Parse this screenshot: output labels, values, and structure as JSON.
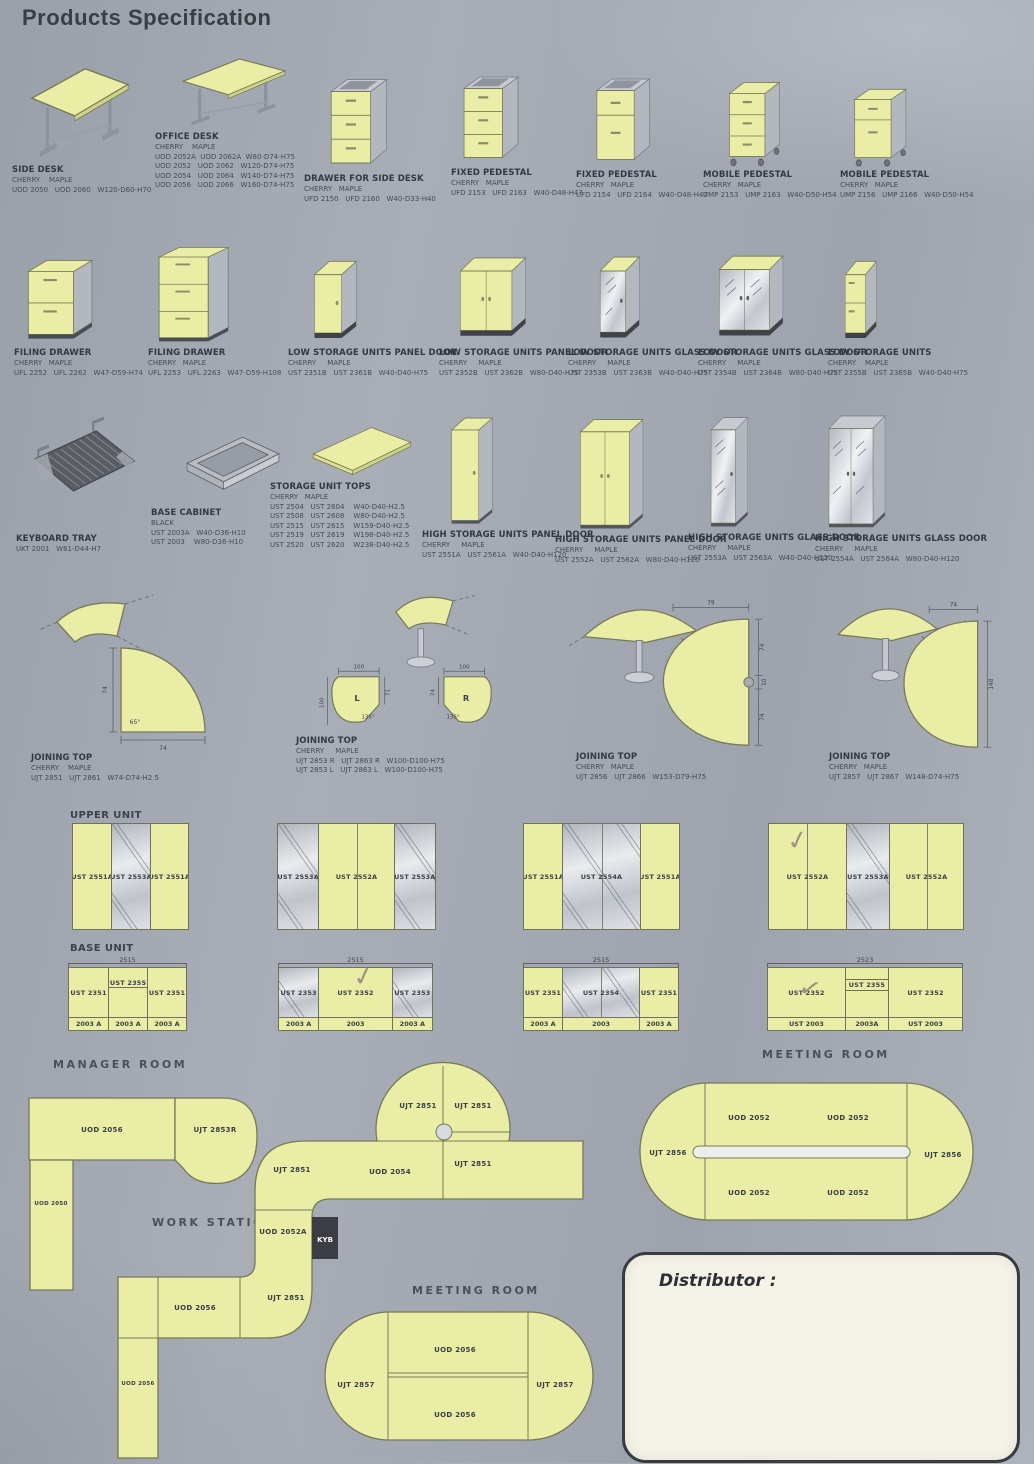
{
  "page": {
    "title": "Products Specification"
  },
  "products": [
    {
      "name": "SIDE DESK",
      "finishes": "CHERRY    MAPLE",
      "rows": [
        "UOD 2050   UOD 2060   W120-D60-H70"
      ]
    },
    {
      "name": "OFFICE DESK",
      "finishes": "CHERRY    MAPLE",
      "rows": [
        "UOD 2052A  UOD 2062A  W80-D74-H75",
        "UOD 2052   UOD 2062   W120-D74-H75",
        "UOD 2054   UOD 2064   W140-D74-H75",
        "UOD 2056   UOD 2066   W160-D74-H75"
      ]
    },
    {
      "name": "DRAWER FOR SIDE DESK",
      "finishes": "CHERRY   MAPLE",
      "rows": [
        "UFD 2150   UFD 2160   W40-D33-H40"
      ]
    },
    {
      "name": "FIXED PEDESTAL",
      "finishes": "CHERRY   MAPLE",
      "rows": [
        "UFD 2153   UFD 2163   W40-D48-H47"
      ]
    },
    {
      "name": "FIXED PEDESTAL",
      "finishes": "CHERRY   MAPLE",
      "rows": [
        "UFD 2154   UFD 2164   W40-D48-H47"
      ]
    },
    {
      "name": "MOBILE PEDESTAL",
      "finishes": "CHERRY   MAPLE",
      "rows": [
        "UMP 2153   UMP 2163   W40-D50-H54"
      ]
    },
    {
      "name": "MOBILE PEDESTAL",
      "finishes": "CHERRY   MAPLE",
      "rows": [
        "UMP 2156   UMP 2166   W40-D50-H54"
      ]
    },
    {
      "name": "FILING DRAWER",
      "finishes": "CHERRY   MAPLE",
      "rows": [
        "UFL 2252   UFL 2262   W47-D59-H74"
      ]
    },
    {
      "name": "FILING DRAWER",
      "finishes": "CHERRY   MAPLE",
      "rows": [
        "UFL 2253   UFL 2263   W47-D59-H108"
      ]
    },
    {
      "name": "LOW STORAGE UNITS PANEL DOOR",
      "finishes": "CHERRY     MAPLE",
      "rows": [
        "UST 2351B   UST 2361B   W40-D40-H75"
      ]
    },
    {
      "name": "LOW STORAGE UNITS PANEL DOOR",
      "finishes": "CHERRY     MAPLE",
      "rows": [
        "UST 2352B   UST 2362B   W80-D40-H75"
      ]
    },
    {
      "name": "LOW STORAGE UNITS GLASS DOOR",
      "finishes": "CHERRY     MAPLE",
      "rows": [
        "UST 2353B   UST 2363B   W40-D40-H75"
      ]
    },
    {
      "name": "LOW STORAGE UNITS GLASS DOOR",
      "finishes": "CHERRY     MAPLE",
      "rows": [
        "UST 2354B   UST 2364B   W80-D40-H75"
      ]
    },
    {
      "name": "LOW STORAGE UNITS",
      "finishes": "CHERRY    MAPLE",
      "rows": [
        "UST 2355B   UST 2365B   W40-D40-H75"
      ]
    },
    {
      "name": "KEYBOARD TRAY",
      "finishes": "",
      "rows": [
        "UKT 2001   W61-D44-H7"
      ]
    },
    {
      "name": "BASE CABINET",
      "finishes": "BLACK",
      "rows": [
        "UST 2003A   W40-D36-H10",
        "UST 2003    W80-D36-H10"
      ]
    },
    {
      "name": "STORAGE UNIT TOPS",
      "finishes": "CHERRY   MAPLE",
      "rows": [
        "UST 2504   UST 2604    W40-D40-H2.5",
        "UST 2508   UST 2608    W80-D40-H2.5",
        "UST 2515   UST 2615    W159-D40-H2.5",
        "UST 2519   UST 2619    W198-D40-H2.5",
        "UST 2520   UST 2620    W238-D40-H2.5"
      ]
    },
    {
      "name": "HIGH STORAGE UNITS PANEL DOOR",
      "finishes": "CHERRY     MAPLE",
      "rows": [
        "UST 2551A   UST 2561A   W40-D40-H120"
      ]
    },
    {
      "name": "HIGH STORAGE UNITS PANEL DOOR",
      "finishes": "CHERRY     MAPLE",
      "rows": [
        "UST 2552A   UST 2562A   W80-D40-H120"
      ]
    },
    {
      "name": "HIGH STORAGE UNITS GLASS DOOR",
      "finishes": "CHERRY     MAPLE",
      "rows": [
        "UST 2553A   UST 2563A   W40-D40-H120"
      ]
    },
    {
      "name": "HIGH STORAGE UNITS GLASS DOOR",
      "finishes": "CHERRY     MAPLE",
      "rows": [
        "UST 2554A   UST 2564A   W80-D40-H120"
      ]
    },
    {
      "name": "JOINING TOP",
      "finishes": "CHERRY    MAPLE",
      "rows": [
        "UJT 2851   UJT 2861   W74-D74-H2.5"
      ]
    },
    {
      "name": "JOINING TOP",
      "finishes": "CHERRY     MAPLE",
      "rows": [
        "UJT 2853 R   UJT 2863 R   W100-D100-H75",
        "UJT 2853 L   UJT 2863 L   W100-D100-H75"
      ]
    },
    {
      "name": "JOINING TOP",
      "finishes": "CHERRY   MAPLE",
      "rows": [
        "UJT 2856   UJT 2866   W153-D79-H75"
      ]
    },
    {
      "name": "JOINING TOP",
      "finishes": "CHERRY   MAPLE",
      "rows": [
        "UJT 2857   UJT 2867   W148-D74-H75"
      ]
    }
  ],
  "joining": [
    {
      "dims": [
        "74",
        "74",
        "65°"
      ]
    },
    {
      "dims": [
        "100",
        "100",
        "100",
        "71",
        "74"
      ],
      "angles": [
        "135°",
        "135°"
      ],
      "letters": [
        "L",
        "R"
      ]
    },
    {
      "dims": [
        "79",
        "74",
        "10",
        "74"
      ]
    },
    {
      "dims": [
        "74",
        "148"
      ]
    }
  ],
  "upper": {
    "title": "UPPER UNIT",
    "panels": [
      [
        "UST 2551A",
        "UST 2553A",
        "UST 2551A"
      ],
      [
        "UST 2553A",
        "UST 2552A",
        "UST 2553A"
      ],
      [
        "UST 2551A",
        "UST 2554A",
        "UST 2551A"
      ],
      [
        "UST 2552A",
        "UST 2553A",
        "UST 2552A"
      ]
    ]
  },
  "base": {
    "title": "BASE UNIT",
    "panels": [
      {
        "dim": "2515",
        "cells": [
          "UST 2351",
          "UST 2355",
          "UST 2351"
        ],
        "feet": [
          "2003 A",
          "2003 A",
          "2003 A"
        ]
      },
      {
        "dim": "2515",
        "cells": [
          "UST 2353",
          "UST 2352",
          "UST 2353"
        ],
        "feet": [
          "2003 A",
          "2003",
          "2003 A"
        ]
      },
      {
        "dim": "2515",
        "cells": [
          "UST 2351",
          "UST 2354",
          "UST 2351"
        ],
        "feet": [
          "2003 A",
          "2003",
          "2003 A"
        ]
      },
      {
        "dim": "2523",
        "cells": [
          "UST 2352",
          "UST 2355",
          "UST 2352"
        ],
        "feet": [
          "UST 2003",
          "2003A",
          "UST 2003"
        ]
      }
    ]
  },
  "rooms": {
    "manager": {
      "title": "MANAGER ROOM",
      "desk": "UOD 2056",
      "joining": "UJT 2853R",
      "return_desk": "UOD 2050"
    },
    "workstation": {
      "title": "WORK STATION",
      "circle": [
        "UJT 2851",
        "UJT 2851",
        "UJT 2851"
      ],
      "desk_mid": "UOD 2054",
      "corner_top": "UJT 2851",
      "desk_vert": "UOD 2052A",
      "keyboard": "KYB",
      "corner_bottom": "UJT 2851",
      "desk_low": "UOD 2056",
      "desk_low_vert": "UOD 2056"
    },
    "meeting1": {
      "title": "MEETING ROOM",
      "left": "UJT 2856",
      "right": "UJT 2856",
      "cells": [
        "UOD 2052",
        "UOD 2052",
        "UOD 2052",
        "UOD 2052"
      ]
    },
    "meeting2": {
      "title": "MEETING ROOM",
      "left": "UJT 2857",
      "right": "UJT 2857",
      "top": "UOD 2056",
      "bottom": "UOD 2056"
    }
  },
  "distributor": {
    "label": "Distributor :"
  }
}
